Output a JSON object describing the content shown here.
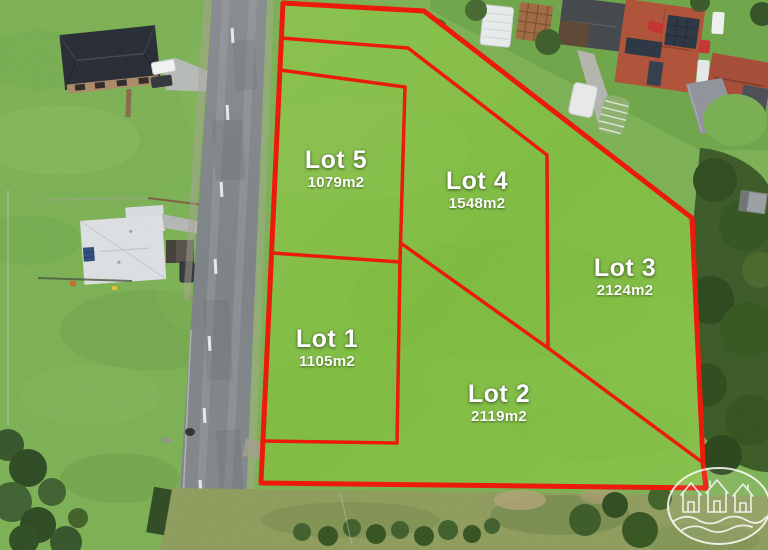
{
  "site_plan": {
    "lots": [
      {
        "name": "Lot 1",
        "area": "1105m2"
      },
      {
        "name": "Lot 2",
        "area": "2119m2"
      },
      {
        "name": "Lot 3",
        "area": "2124m2"
      },
      {
        "name": "Lot 4",
        "area": "1548m2"
      },
      {
        "name": "Lot 5",
        "area": "1079m2"
      }
    ],
    "boundary_color": "#ed1607",
    "lot_fill_color": "#83c046",
    "label_text_color": "#ffffff"
  },
  "watermark": {
    "icon": "three-houses-wave-oval-logo",
    "color": "#ffffff"
  }
}
